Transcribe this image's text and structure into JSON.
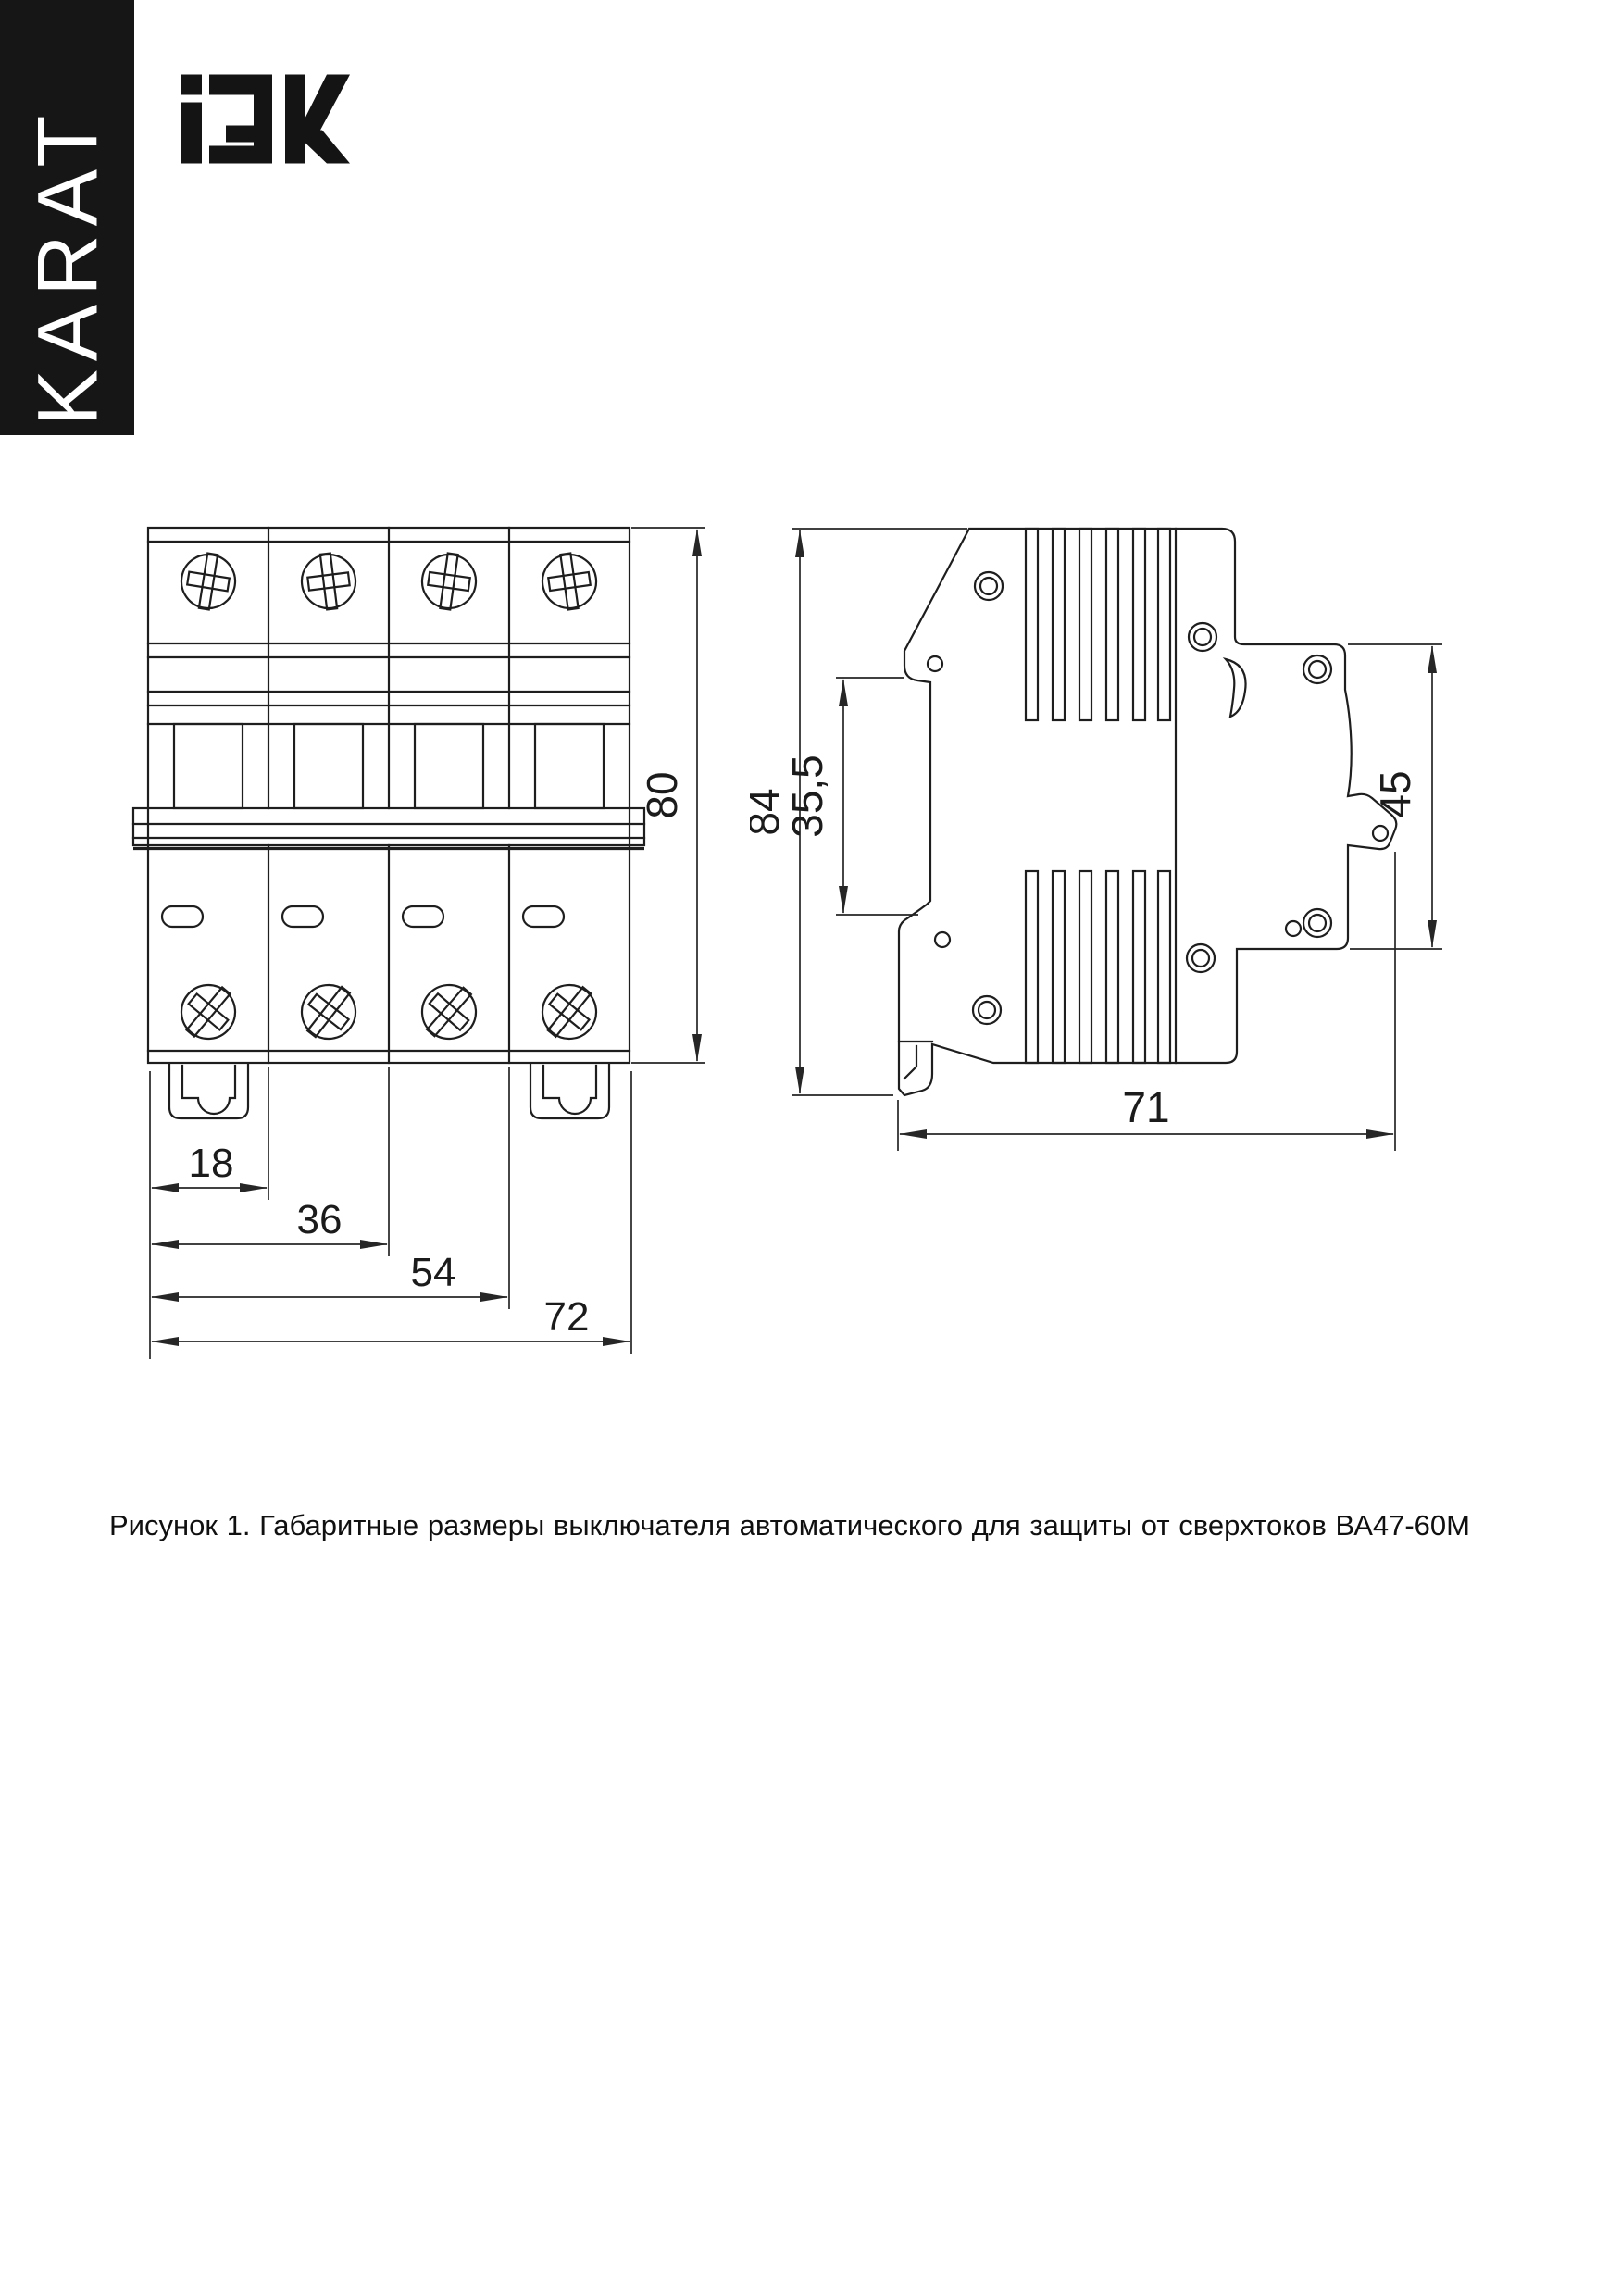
{
  "page": {
    "background": "#ffffff",
    "ink": "#1e1e1e"
  },
  "brand": {
    "sidebar_label": "KARAT",
    "logo_text": "IEK",
    "bar_color": "#161616"
  },
  "figure": {
    "caption": "Рисунок 1. Габаритные размеры выключателя автоматического для защиты от сверхтоков ВА47-60М",
    "front_view": {
      "dims": {
        "height": "80",
        "module_1": "18",
        "module_2": "36",
        "module_3": "54",
        "total_width": "72"
      }
    },
    "side_view": {
      "dims": {
        "height": "84",
        "din_rail": "35,5",
        "front_height": "45",
        "total_depth": "71"
      }
    }
  }
}
